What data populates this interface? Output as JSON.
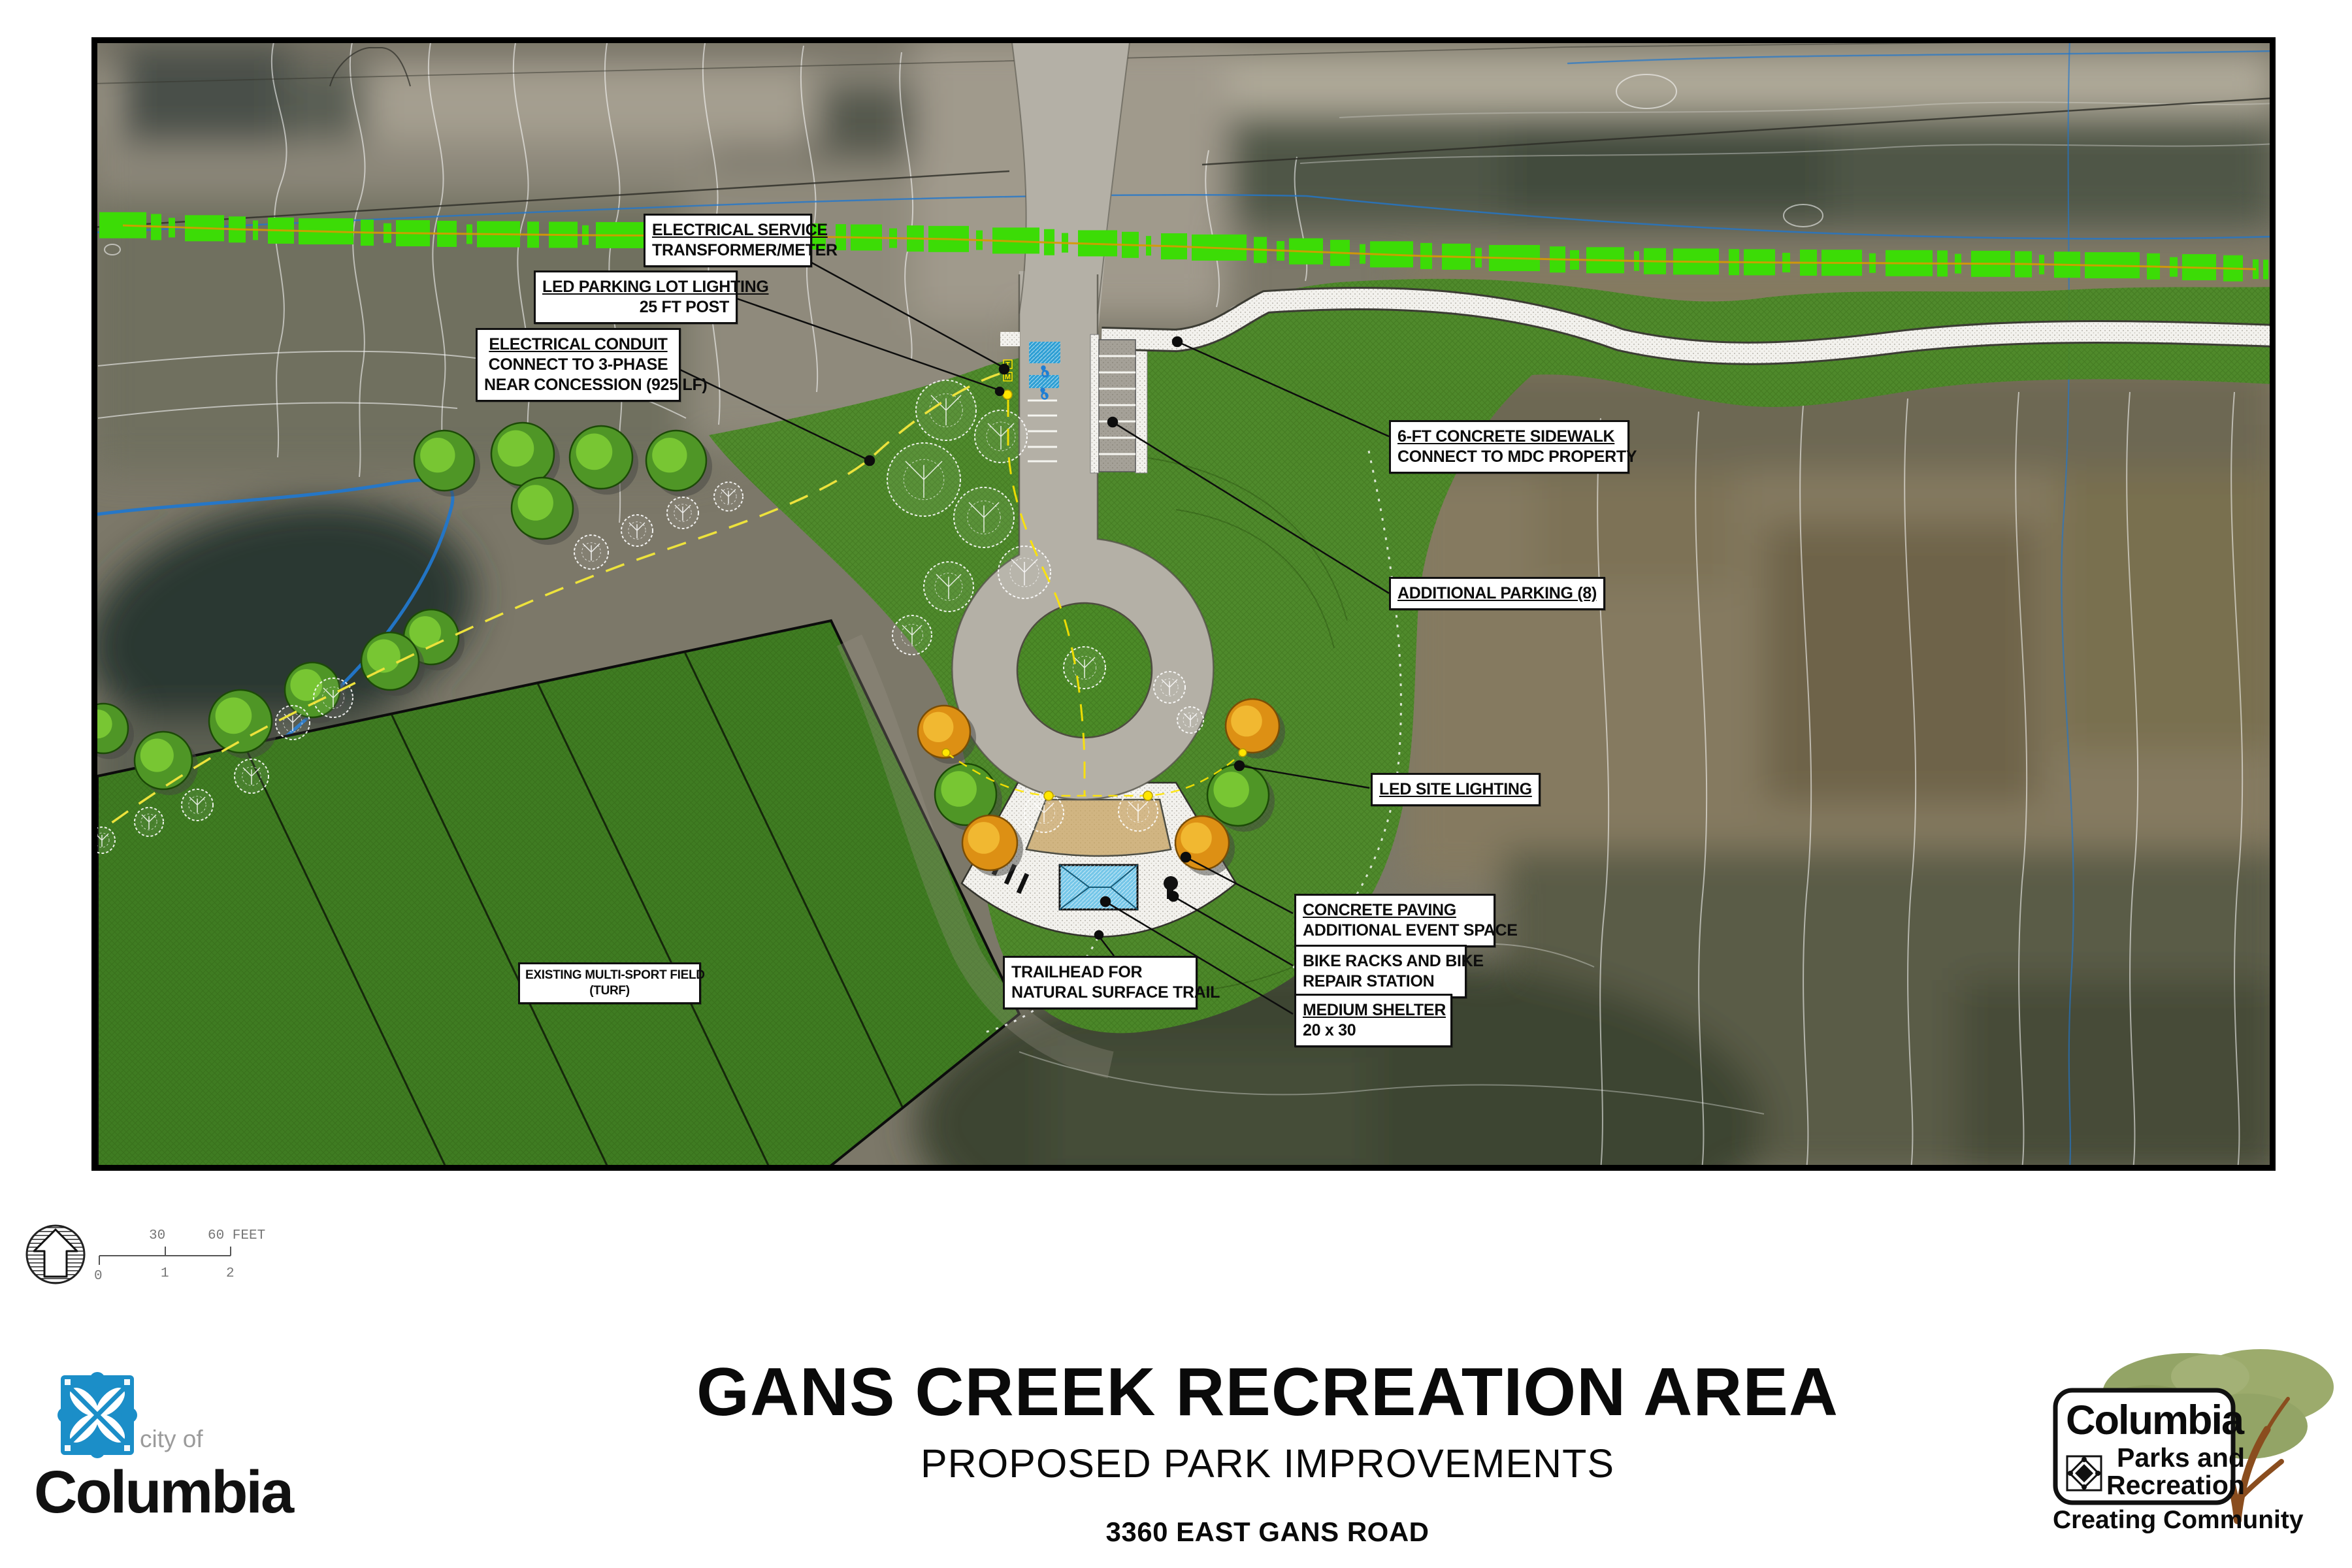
{
  "title_block": {
    "title": "GANS CREEK RECREATION AREA",
    "subtitle": "PROPOSED PARK IMPROVEMENTS",
    "address": "3360 EAST GANS ROAD"
  },
  "logos": {
    "city": {
      "prefix": "city of",
      "name": "Columbia"
    },
    "parks": {
      "name": "Columbia",
      "line2": "Parks and",
      "line3": "Recreation",
      "tagline": "Creating Community"
    }
  },
  "north_scale": {
    "top_labels": [
      "30",
      "60 FEET"
    ],
    "bottom_labels": [
      "0",
      "1",
      "2"
    ]
  },
  "plan_symbols": {
    "transformer": "T",
    "meter": "M"
  },
  "callouts": [
    {
      "id": "electrical-service",
      "lines": [
        "ELECTRICAL SERVICE",
        "TRANSFORMER/METER"
      ]
    },
    {
      "id": "led-parking-lot-lighting",
      "lines": [
        "LED PARKING LOT LIGHTING",
        "25 FT POST"
      ]
    },
    {
      "id": "electrical-conduit",
      "lines": [
        "ELECTRICAL CONDUIT",
        "CONNECT TO 3-PHASE",
        "NEAR CONCESSION (925 LF)"
      ]
    },
    {
      "id": "concrete-sidewalk",
      "lines": [
        "6-FT CONCRETE SIDEWALK",
        "CONNECT TO MDC PROPERTY"
      ]
    },
    {
      "id": "additional-parking",
      "lines": [
        "ADDITIONAL PARKING (8)"
      ]
    },
    {
      "id": "led-site-lighting",
      "lines": [
        "LED SITE LIGHTING"
      ]
    },
    {
      "id": "concrete-paving",
      "lines": [
        "CONCRETE PAVING",
        "ADDITIONAL EVENT SPACE"
      ]
    },
    {
      "id": "bike-racks",
      "lines": [
        "BIKE RACKS AND BIKE",
        "REPAIR STATION"
      ]
    },
    {
      "id": "medium-shelter",
      "lines": [
        "MEDIUM SHELTER",
        "20 x 30"
      ]
    },
    {
      "id": "trailhead",
      "lines": [
        "TRAILHEAD FOR",
        "NATURAL SURFACE TRAIL"
      ]
    },
    {
      "id": "multi-sport-field",
      "lines": [
        "EXISTING MULTI-SPORT FIELD",
        "(TURF)"
      ]
    }
  ],
  "colors": {
    "conduit_green": "#3cdc06",
    "conduit_core": "#d79a00",
    "grass": "#4c8b28",
    "field_green": "#3f7c22",
    "ada_blue": "#2e9fd4",
    "shelter_blue": "#74c6e8",
    "event_tan": "#c7a463",
    "tree_green": "#4f9626",
    "tree_green_light": "#7ccb35",
    "tree_orange": "#dd9014",
    "tree_orange_light": "#f3bc34",
    "creek_blue": "#2277cc",
    "light_yellow": "#ffe600",
    "road_gray": "#b4b0a6",
    "city_blue": "#1b8ec8",
    "canopy_olive": "#93a466",
    "trunk_brown": "#8a4d1e"
  }
}
